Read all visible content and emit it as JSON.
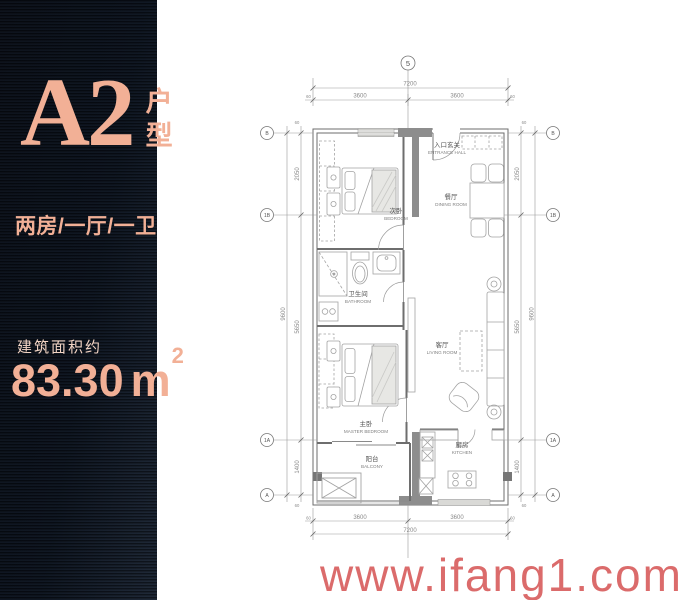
{
  "panel": {
    "unit_code": "A2",
    "unit_type_label": "户型",
    "rooms_summary": "两房/一厅/一卫",
    "area_caption": "建筑面积约",
    "area_value": "83.30",
    "area_unit": "m",
    "area_exponent": "2"
  },
  "watermark": {
    "text": "www.ifang1.com"
  },
  "floorplan": {
    "axes": {
      "top": "5",
      "left": [
        "B",
        "1B",
        "1A",
        "A"
      ],
      "right": [
        "B",
        "1B",
        "1A",
        "A"
      ]
    },
    "dimensions": {
      "top": {
        "total": "7200",
        "segments": [
          "3600",
          "3600"
        ],
        "offsets": [
          "60",
          "60"
        ]
      },
      "bottom": {
        "total": "7200",
        "segments": [
          "3600",
          "3600"
        ],
        "offsets": [
          "60",
          "60"
        ]
      },
      "left": {
        "total": "9600",
        "segments": [
          "2050",
          "5650",
          "1400"
        ],
        "offsets": [
          "60",
          "60"
        ]
      },
      "right": {
        "total": "9600",
        "segments": [
          "2050",
          "5650",
          "1400"
        ],
        "offsets": [
          "60",
          "60"
        ]
      }
    },
    "rooms": [
      {
        "cn": "次卧",
        "en": "BEDROOM"
      },
      {
        "cn": "入口玄关",
        "en": "ENTRANCE HALL"
      },
      {
        "cn": "餐厅",
        "en": "DINING ROOM"
      },
      {
        "cn": "卫生间",
        "en": "BATHROOM"
      },
      {
        "cn": "客厅",
        "en": "LIVING ROOM"
      },
      {
        "cn": "主卧",
        "en": "MASTER BEDROOM"
      },
      {
        "cn": "阳台",
        "en": "BALCONY"
      },
      {
        "cn": "厨房",
        "en": "KITCHEN"
      }
    ]
  },
  "colors": {
    "panel_bg": "#0c1420",
    "accent": "#f2b096",
    "watermark": "#d85f5f",
    "plan_line": "#6e6e6e"
  }
}
